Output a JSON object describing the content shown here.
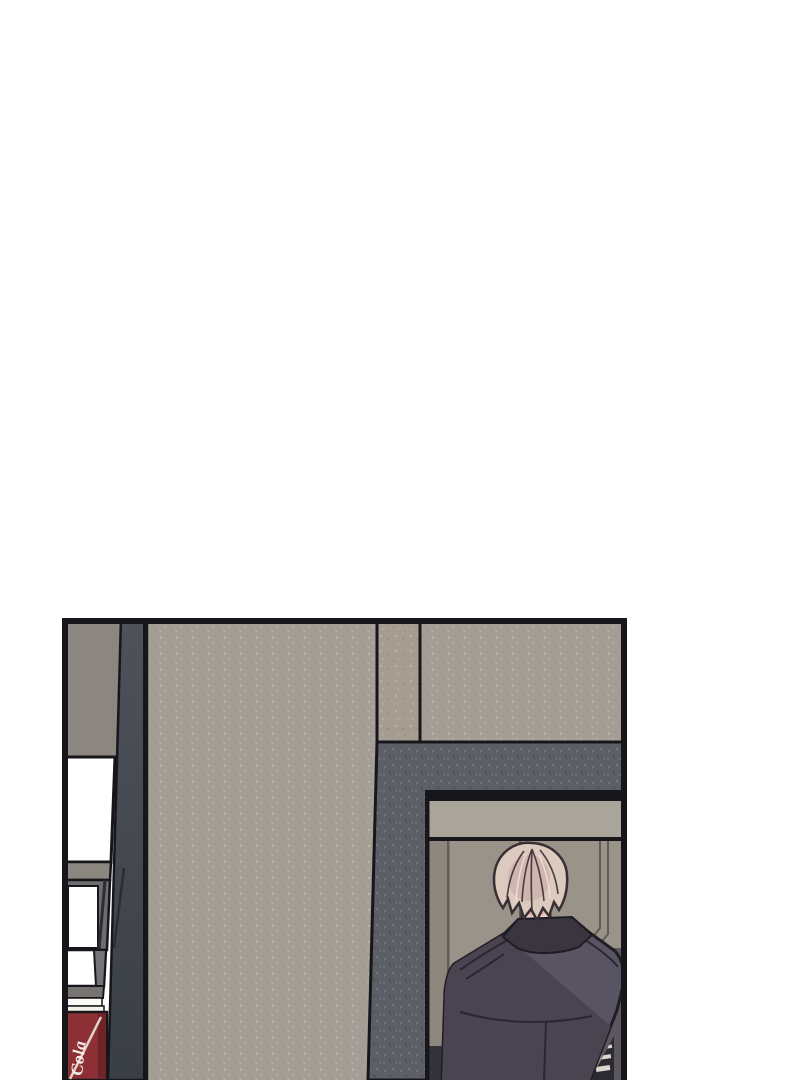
{
  "page": {
    "background": "#ffffff",
    "type_label": "comic panel"
  },
  "vending_machine": {
    "brand_text": "Cola"
  },
  "palette": {
    "outline": "#17171b",
    "wall_beige": "#a49e96",
    "pilaster": "#a69d92",
    "wall_dark": "#5d5f66",
    "slate_top": "#4e525a",
    "slate_bottom": "#3a3e45",
    "sign_taupe": "#8c8681",
    "window_white": "#ffffff",
    "storefront_gray": "#6e6d6d",
    "storefront_gray2": "#75737a",
    "storefront_bar": "#777370",
    "lintel": "#aaa59b",
    "interior_wall": "#9a9389",
    "interior_line": "#615c55",
    "interior_shadow": "#5b5660",
    "coke_red": "#8d3035",
    "coke_red_dark": "#6e2428",
    "coke_cap": "#f4f1ea",
    "coke_text": "#f3efe8",
    "skin": "#eccdc3",
    "blush": "#d8908a",
    "hair_base": "#dccabf",
    "hair_shade": "#c8a4a4",
    "hair_outline": "#382f35",
    "jacket_light": "#595461",
    "jacket_dark": "#494450",
    "collar": "#3a3640",
    "jacket_seam": "#282331",
    "stripe_light": "#d9d6d0",
    "stripe_dark": "#2b2a30"
  }
}
